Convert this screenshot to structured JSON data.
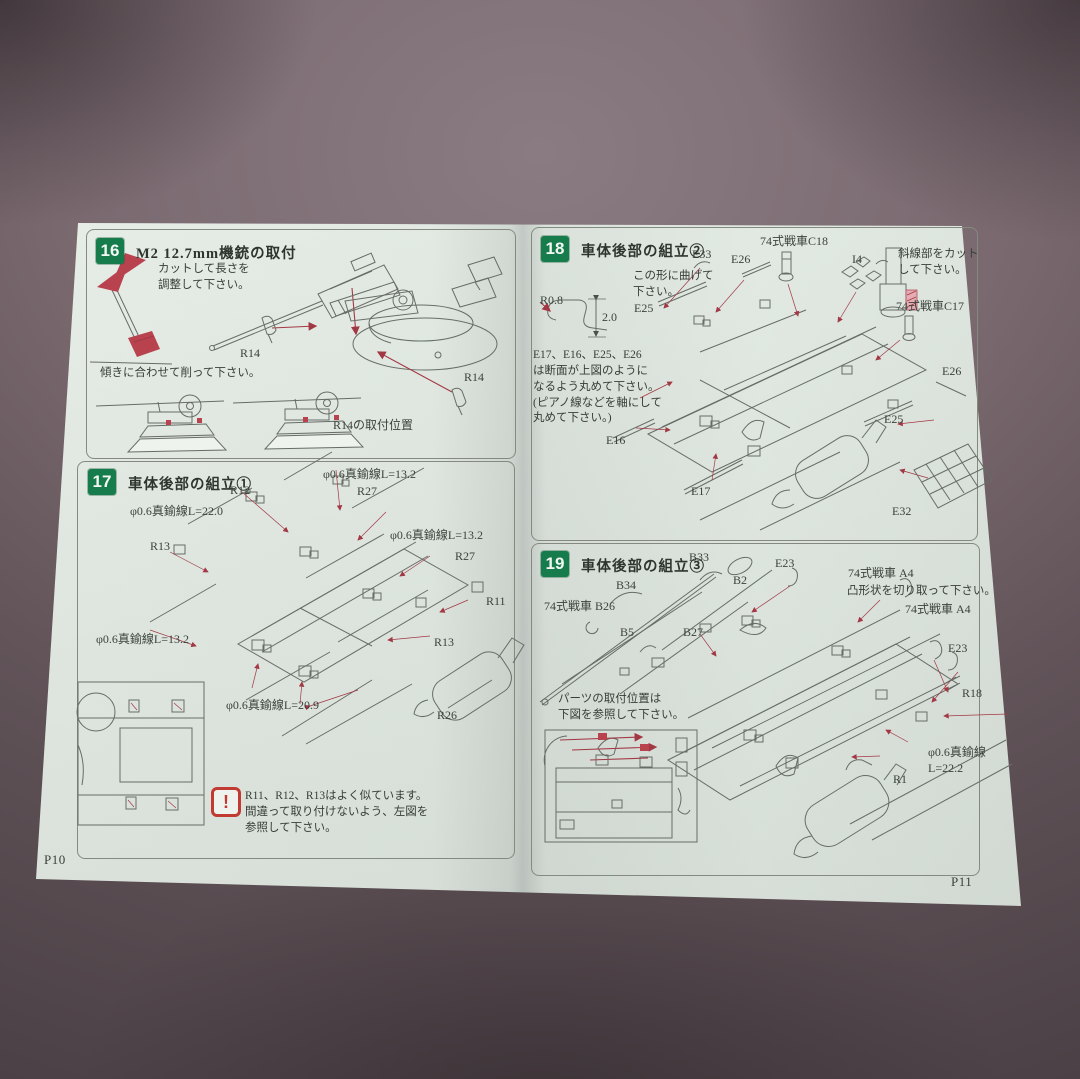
{
  "colors": {
    "badge_green": "#177c4b",
    "arrow_red": "#a23844",
    "warning_red": "#c23b33",
    "highlight_pink": "#e5adb3",
    "page_paper": "#e3eae4"
  },
  "booklet": {
    "left_page_number": "P10",
    "right_page_number": "P11"
  },
  "step16": {
    "number": "16",
    "title": "M2 12.7mm機銃の取付",
    "note_cut": "カットして長さを\n調整して下さい。",
    "note_shave": "傾きに合わせて削って下さい。",
    "r14_a": "R14",
    "r14_b": "R14",
    "note_r14_pos": "R14の取付位置"
  },
  "step17": {
    "number": "17",
    "title": "車体後部の組立①",
    "wire_13_top": "φ0.6真鍮線L=13.2",
    "r27_top": "R27",
    "r12": "R12",
    "wire_22": "φ0.6真鍮線L=22.0",
    "r13_left": "R13",
    "wire_13_right": "φ0.6真鍮線L=13.2",
    "r27_right": "R27",
    "r11": "R11",
    "wire_13_bottom": "φ0.6真鍮線L=13.2",
    "r13_right": "R13",
    "wire_209": "φ0.6真鍮線L=20.9",
    "r26": "R26",
    "warning": "R11、R12、R13はよく似ています。\n間違って取り付けないよう、左図を\n参照して下さい。"
  },
  "step18": {
    "number": "18",
    "title": "車体後部の組立②",
    "e33": "E33",
    "e26_top": "E26",
    "c18": "74式戦車C18",
    "i4": "I4",
    "note_hatch": "斜線部をカット\nして下さい。",
    "note_bend": "この形に曲げて\n下さい。",
    "r08": "R0.8",
    "dim20": "2.0",
    "e25_left": "E25",
    "note_section": "E17、E16、E25、E26\nは断面が上図のように\nなるよう丸めて下さい。\n(ピアノ線などを軸にして\n丸めて下さい。)",
    "c17": "74式戦車C17",
    "e26_right": "E26",
    "e16": "E16",
    "e17": "E17",
    "e25_right": "E25",
    "e32": "E32"
  },
  "step19": {
    "number": "19",
    "title": "車体後部の組立③",
    "b33": "B33",
    "b34": "B34",
    "b26": "74式戦車 B26",
    "b5": "B5",
    "b2": "B2",
    "b27": "B27",
    "e23_left": "E23",
    "a4_top": "74式戦車  A4",
    "note_cut": "凸形状を切り取って下さい。",
    "a4_right": "74式戦車  A4",
    "e23_right": "E23",
    "r18": "R18",
    "note_pos": "パーツの取付位置は\n下図を参照して下さい。",
    "r1": "R1",
    "wire_222": "φ0.6真鍮線\nL=22.2"
  }
}
